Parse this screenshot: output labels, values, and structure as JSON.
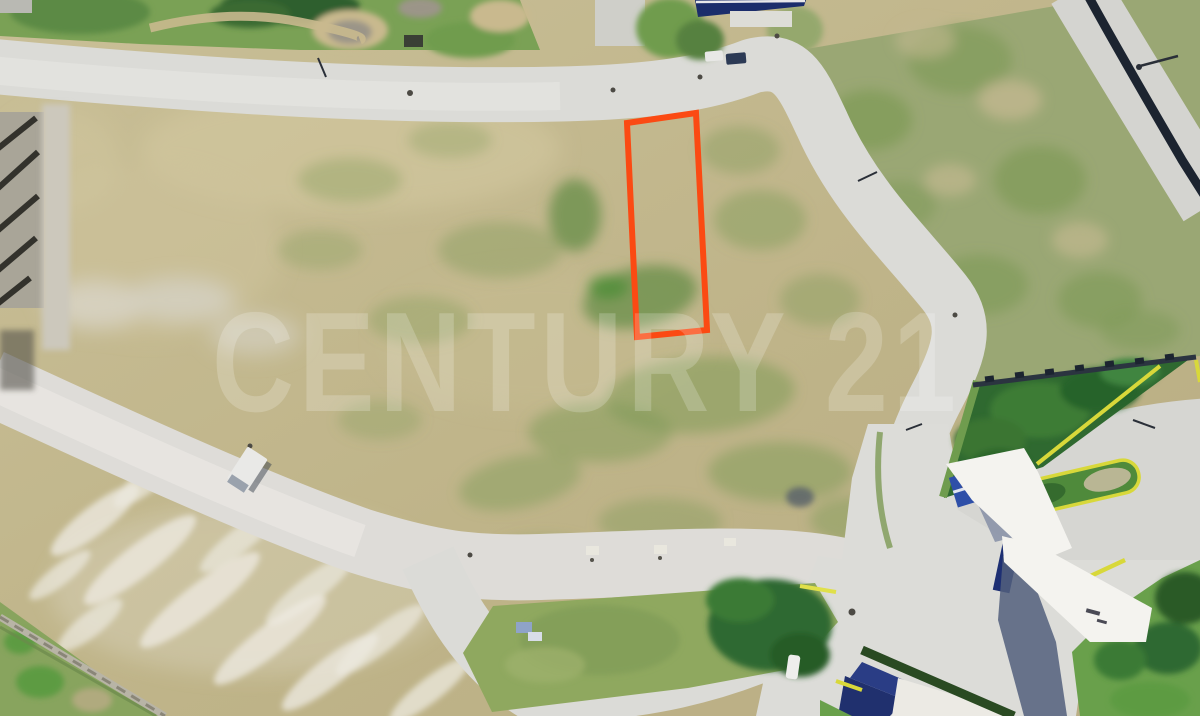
{
  "image": {
    "kind": "aerial-drone-photograph",
    "subject": "vacant residential land lot outlined for sale inside a gated subdivision under development",
    "view": "top-down (nadir) view",
    "width_px": 1200,
    "height_px": 716
  },
  "watermark": {
    "text": "CENTURY 21",
    "color": "#ffffff",
    "opacity": 0.2
  },
  "lot_marker": {
    "description": "orange boundary outline highlighting the lot for sale",
    "color": "#fb4a13",
    "stroke_width": 6,
    "points_attr": "627,123 696,113 707,330 637,337"
  },
  "scene": {
    "ground_color": "#c2b88f",
    "road_color": "#dbdbd7",
    "grass_color": "#8aa05e",
    "trees_color": "#2f6930",
    "lawn_color": "#69a04b",
    "wall_color": "#1c2430",
    "curb_color": "#e0e04a",
    "canopy_color": "#f4f3ef",
    "gatehouse_roof_color": "#2e4fa8",
    "regions": [
      {
        "name": "top-vegetation-strip",
        "desc": "grass, trees and dirt path along top edge"
      },
      {
        "name": "upper-road",
        "desc": "concrete road curving from left edge, bending south near top right"
      },
      {
        "name": "right-perimeter-wall",
        "desc": "dark perimeter wall with outer road, top right corner"
      },
      {
        "name": "central-dirt-field",
        "desc": "large cleared tan lot area with green regrowth patches"
      },
      {
        "name": "lower-road",
        "desc": "concrete road crossing lower left to junction at right"
      },
      {
        "name": "grass-median-triangle",
        "desc": "triangular green median with tree cluster, bottom center"
      },
      {
        "name": "entrance-complex",
        "desc": "subdivision gate: white canopies, blue gatehouse, yellow-curbed islands, lawns"
      },
      {
        "name": "bottom-left-wall",
        "desc": "light perimeter wall with grass corner"
      }
    ],
    "vehicles": [
      {
        "name": "box-truck",
        "approx_xy": [
          248,
          468
        ]
      },
      {
        "name": "white-car-top",
        "approx_xy": [
          714,
          56
        ]
      },
      {
        "name": "dark-car-top",
        "approx_xy": [
          736,
          59
        ]
      },
      {
        "name": "white-car-gate",
        "approx_xy": [
          795,
          668
        ]
      }
    ]
  }
}
